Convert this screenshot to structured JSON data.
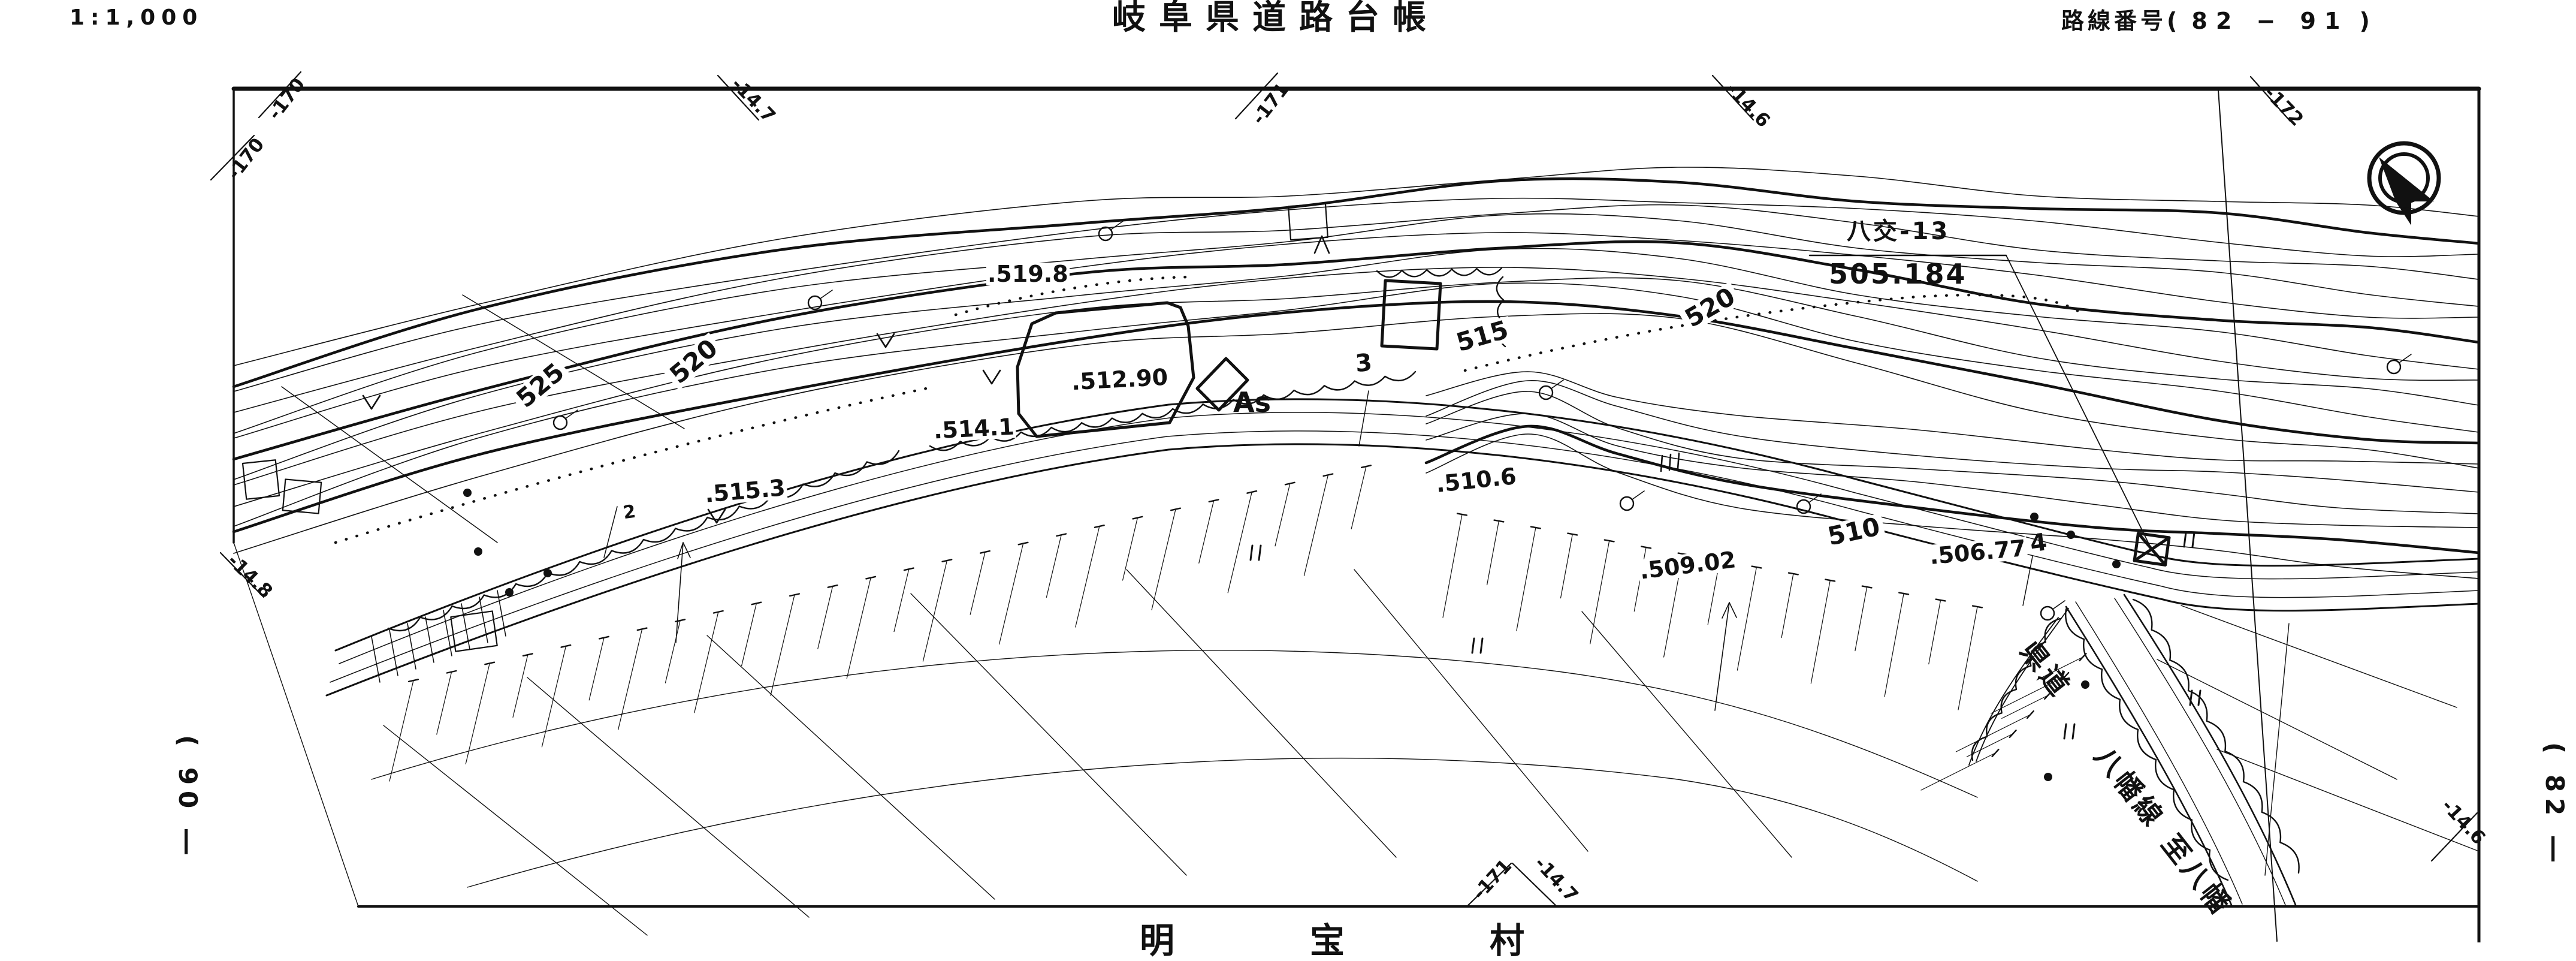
{
  "sheet": {
    "scale": "1:1,000",
    "title": "岐阜県道路台帳",
    "route_label": "路線番号(",
    "route_number": "82 − 91",
    "route_close": ")",
    "bottom_place_chars": [
      "明",
      "宝",
      "村"
    ]
  },
  "benchmark": {
    "name": "八交-13",
    "elevation": "505.184"
  },
  "grid_ticks": {
    "top": [
      "-170",
      "-14.7",
      "-171",
      "-14.6",
      "-172"
    ],
    "left": [
      "-170",
      "-14.8"
    ],
    "bottom": [
      "-171",
      "-14.7"
    ],
    "right": [
      "-14.6"
    ]
  },
  "adjacent_sheets": {
    "left": "( 90 ―",
    "right": "( 82 ―"
  },
  "contour_labels": [
    "525",
    "520",
    "515",
    "520",
    "510"
  ],
  "spot_elevations": [
    ".519.8",
    ".512.90",
    ".514.1",
    ".515.3",
    ".510.6",
    ".509.02",
    ".506.77"
  ],
  "road": {
    "surface": "As",
    "stations": [
      "2",
      "3",
      "4"
    ],
    "name_part1": "県道",
    "name_part2": "八幡線",
    "destination": "至八幡"
  },
  "icons": {
    "north_arrow": "north-arrow",
    "benchmark_box": "crossed-box",
    "pole": "utility-pole-circle",
    "paddy": "rice-field-mark",
    "vegetation_v": "vegetation-v-mark",
    "vegetation_a": "vegetation-triangle-mark"
  }
}
